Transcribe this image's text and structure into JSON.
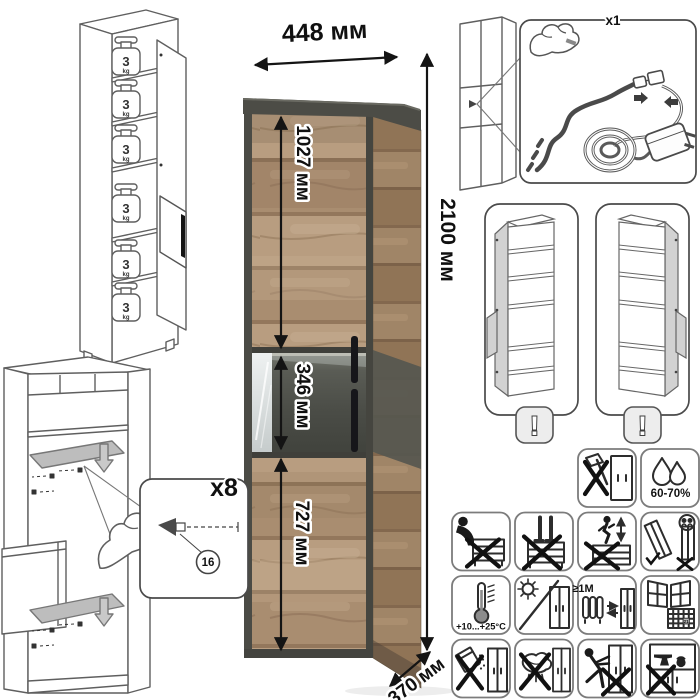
{
  "cabinet": {
    "width": "448 мм",
    "height": "2100 мм",
    "upper_section": "1027 мм",
    "display_section": "346 мм",
    "lower_section": "727 мм",
    "depth": "370 мм"
  },
  "shelf_load": {
    "value": "3",
    "unit": "kg"
  },
  "led_kit": {
    "count": "x1"
  },
  "door_reversible": {
    "warning": "!"
  },
  "shelf_pins": {
    "count": "x8",
    "part": "16"
  },
  "care": {
    "humidity": "60-70%",
    "temperature": "+10...+25°C",
    "min_distance": "≥1М",
    "calendar_day": "21"
  },
  "colors": {
    "wood": "#b89d80",
    "graphite": "#4b4b45",
    "accent_dark_panel": "#4a4c46"
  }
}
